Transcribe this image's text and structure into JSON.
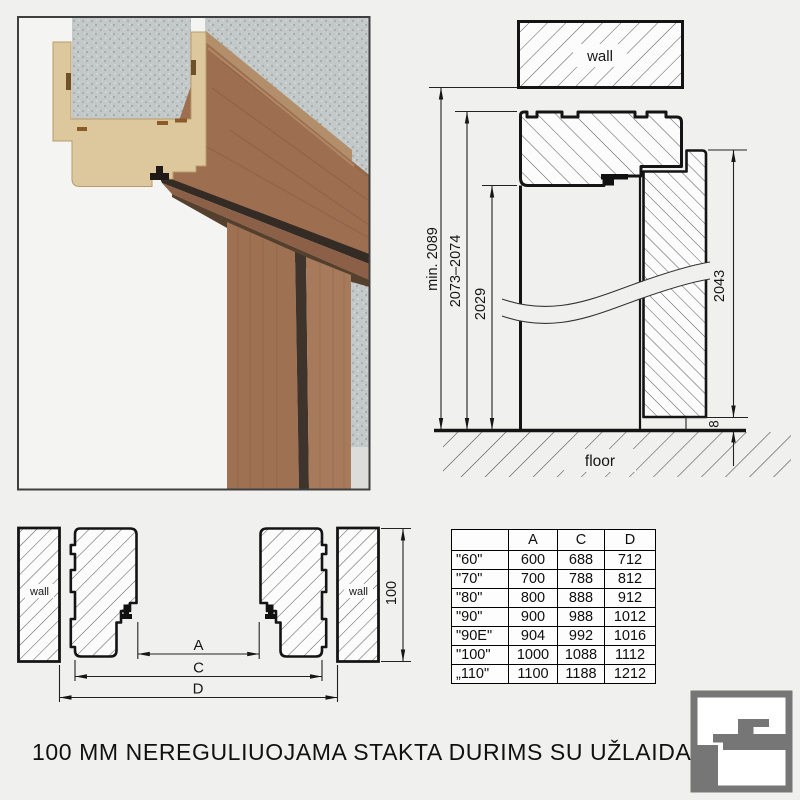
{
  "title": "100 MM NEREGULIUOJAMA STAKTA DURIMS SU UŽLAIDA",
  "top_right_drawing": {
    "wall_label": "wall",
    "floor_label": "floor",
    "dim_min_total": "min. 2089",
    "dim_frame_outer": "2073–2074",
    "dim_clear_opening": "2029",
    "dim_door_leaf": "2043",
    "dim_floor_gap": "8"
  },
  "bottom_left_drawing": {
    "wall_left_label": "wall",
    "wall_right_label": "wall",
    "dim_a_label": "A",
    "dim_c_label": "C",
    "dim_d_label": "D",
    "dim_depth": "100"
  },
  "size_table": {
    "headers": [
      "",
      "A",
      "C",
      "D"
    ],
    "rows": [
      [
        "\"60\"",
        "600",
        "688",
        "712"
      ],
      [
        "\"70\"",
        "700",
        "788",
        "812"
      ],
      [
        "\"80\"",
        "800",
        "888",
        "912"
      ],
      [
        "\"90\"",
        "900",
        "988",
        "1012"
      ],
      [
        "\"90E\"",
        "904",
        "992",
        "1016"
      ],
      [
        "\"100\"",
        "1000",
        "1088",
        "1112"
      ],
      [
        "„110\"",
        "1100",
        "1188",
        "1212"
      ]
    ]
  },
  "colors": {
    "background": "#f0f0ef",
    "line": "#141414",
    "logo_gray": "#767676",
    "wood": "#9d6f50",
    "mdf": "#ddc89d",
    "concrete": "#c2c9c8"
  }
}
